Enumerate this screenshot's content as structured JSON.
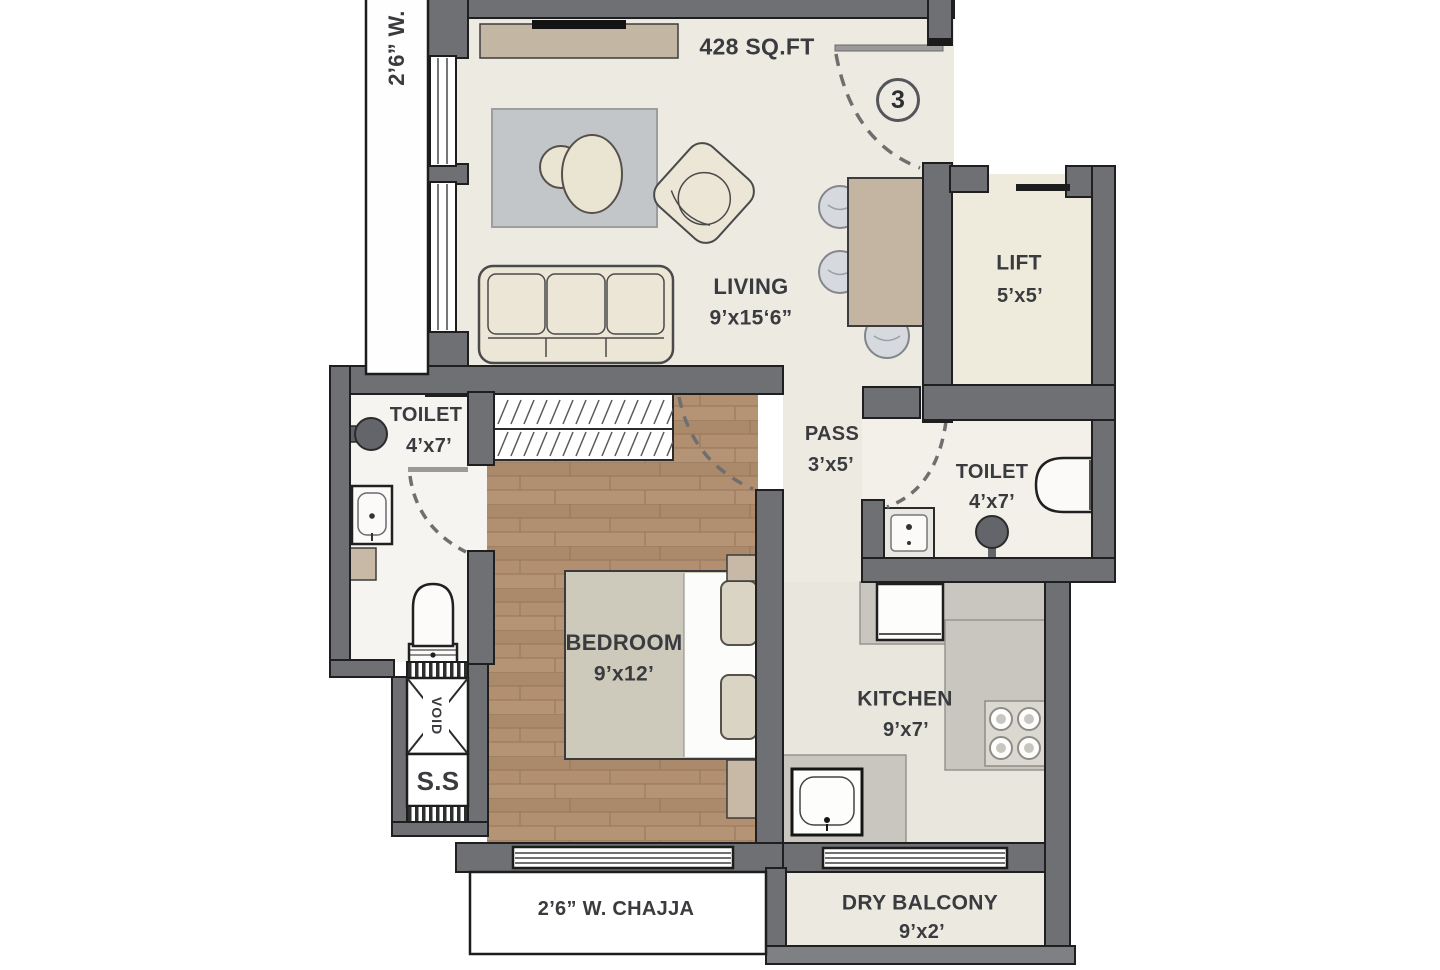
{
  "plan": {
    "area": "428 SQ.FT",
    "unit_number": "3",
    "rooms": {
      "living": {
        "name": "LIVING",
        "dims": "9’x15‘6”"
      },
      "lift": {
        "name": "LIFT",
        "dims": "5’x5’"
      },
      "toilet_left": {
        "name": "TOILET",
        "dims": "4’x7’"
      },
      "toilet_right": {
        "name": "TOILET",
        "dims": "4’x7’"
      },
      "pass": {
        "name": "PASS",
        "dims": "3’x5’"
      },
      "bedroom": {
        "name": "BEDROOM",
        "dims": "9’x12’"
      },
      "kitchen": {
        "name": "KITCHEN",
        "dims": "9’x7’"
      },
      "dry_balcony": {
        "name": "DRY BALCONY",
        "dims": "9’x2’"
      }
    },
    "annotations": {
      "left_ledge": "2’6” W.",
      "chajja": "2’6” W. CHAJJA",
      "service_shaft": "S.S",
      "void": "VOID"
    },
    "colors": {
      "wall": "#6e7073",
      "living_floor": "#edeae2",
      "wood_floor": "#b28f70",
      "counter_grey": "#c9c6bf",
      "furniture_tan": "#c3b5a2",
      "furniture_cream": "#ece6d6",
      "rug_grey": "#c2c6c9",
      "text": "#3a3b3e"
    }
  }
}
